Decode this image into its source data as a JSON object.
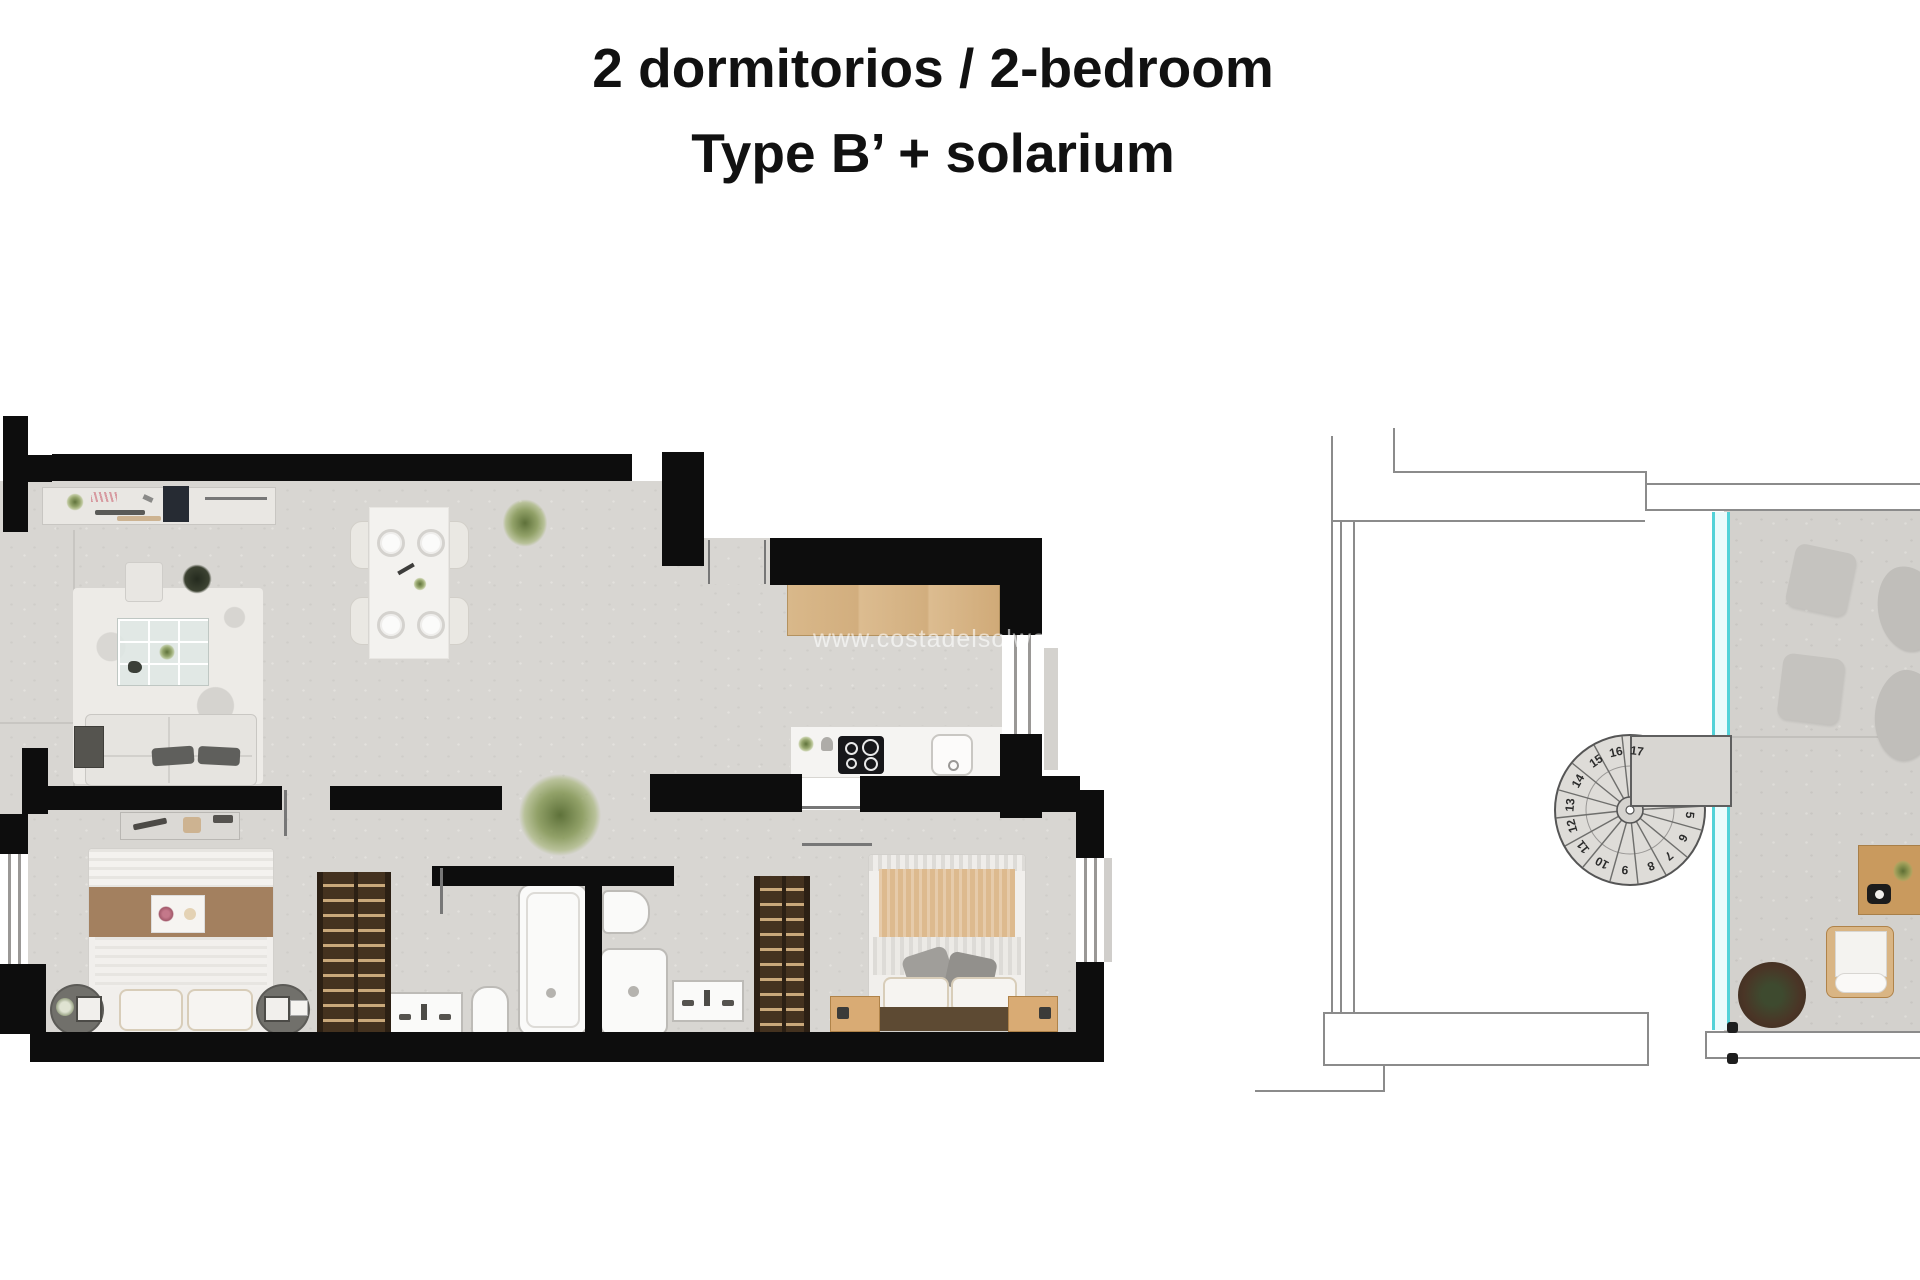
{
  "title": {
    "line1": "2 dormitorios / 2-bedroom",
    "line2": "Type B’ + solarium"
  },
  "watermark": "www.costadelsolwoning.nl",
  "solarium": {
    "stairs": {
      "numbers": [
        "5",
        "6",
        "7",
        "8",
        "9",
        "10",
        "11",
        "12",
        "13",
        "14",
        "15",
        "16",
        "17"
      ]
    }
  },
  "colors": {
    "wall": "#0d0d0d",
    "floor": "#d8d6d2",
    "glass_accent": "#52d2d8",
    "wood": "#d2ae7e",
    "wardrobe": "#44321f",
    "outline": "#8b8b8b"
  }
}
